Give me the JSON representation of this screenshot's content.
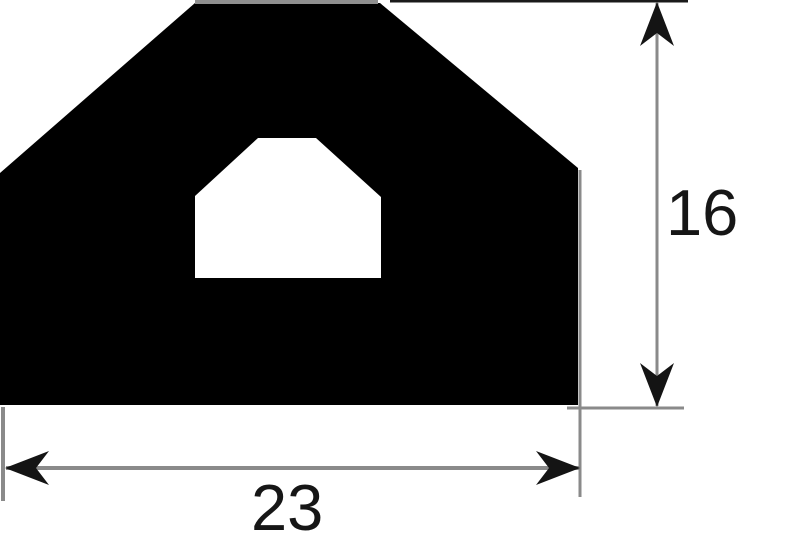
{
  "figure": {
    "kind": "technical-drawing-profile-cross-section",
    "outer_profile_points": "195,3 380,3 578,168 578,405 0,405 0,173",
    "inner_cavity_points": "258,138 316,138 381,197 381,278 195,278 195,196"
  },
  "dimensions": {
    "width": {
      "label": "23"
    },
    "height": {
      "label": "16"
    }
  },
  "colors": {
    "profile_fill": "#000000",
    "cavity_fill": "#ffffff",
    "dimension_line_gray": "#8a8a8a",
    "profile_top_edge_gray": "#8f8f8f",
    "extension_line_dark": "#1a1a1a",
    "arrowhead_black": "#141414",
    "label_text": "#161616",
    "background": "#ffffff"
  }
}
